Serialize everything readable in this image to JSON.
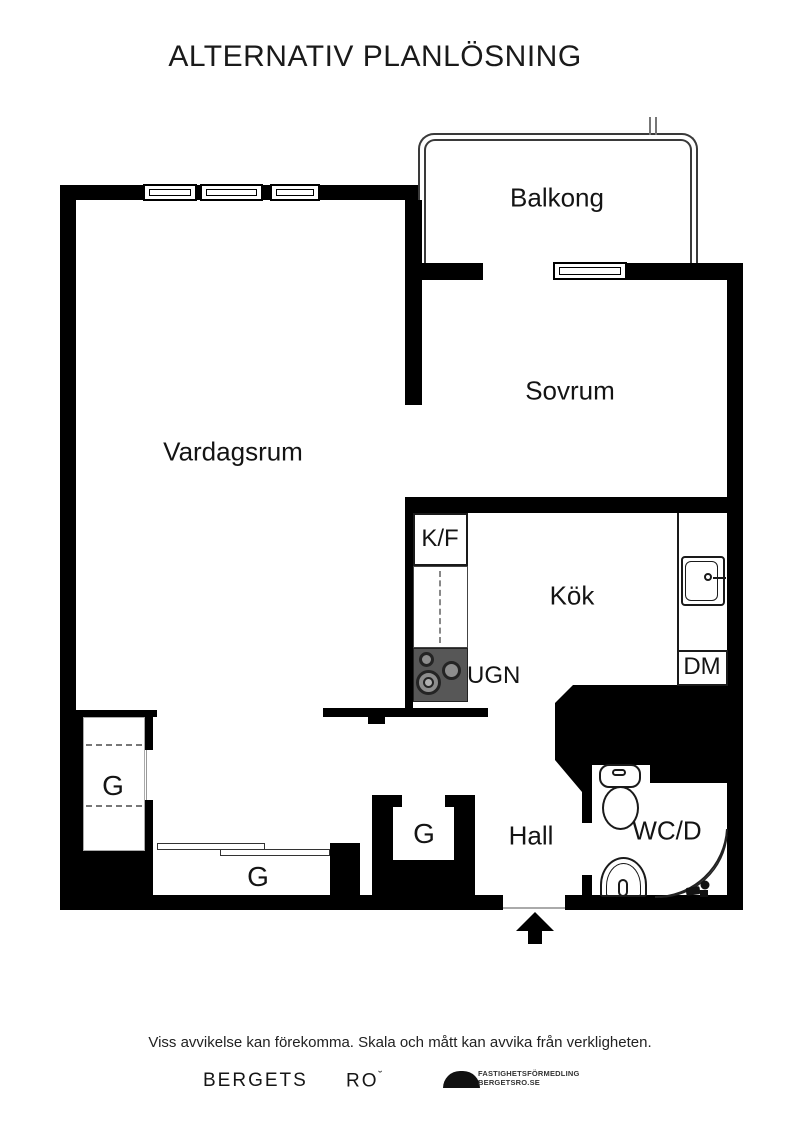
{
  "title": "ALTERNATIV PLANLÖSNING",
  "rooms": {
    "balcony": {
      "label": "Balkong"
    },
    "bedroom": {
      "label": "Sovrum"
    },
    "living_room": {
      "label": "Vardagsrum"
    },
    "kitchen": {
      "label": "Kök"
    },
    "hall": {
      "label": "Hall"
    },
    "bathroom": {
      "label": "WC/D"
    }
  },
  "fixtures": {
    "fridge_freezer": "K/F",
    "oven": "UGN",
    "dishwasher": "DM"
  },
  "wardrobes": {
    "left_tall": "G",
    "bottom_wide": "G",
    "hall_closet": "G"
  },
  "footer": {
    "disclaimer": "Viss avvikelse kan förekomma. Skala och mått kan avvika från verkligheten.",
    "brand_word1": "BERGETS",
    "brand_word2": "RO",
    "brand_mark": "˘",
    "brand_sub1": "FASTIGHETSFÖRMEDLING",
    "brand_sub2": "BERGETSRO.SE"
  },
  "colors": {
    "wall": "#000000",
    "stove": "#575757",
    "line": "#222222"
  }
}
